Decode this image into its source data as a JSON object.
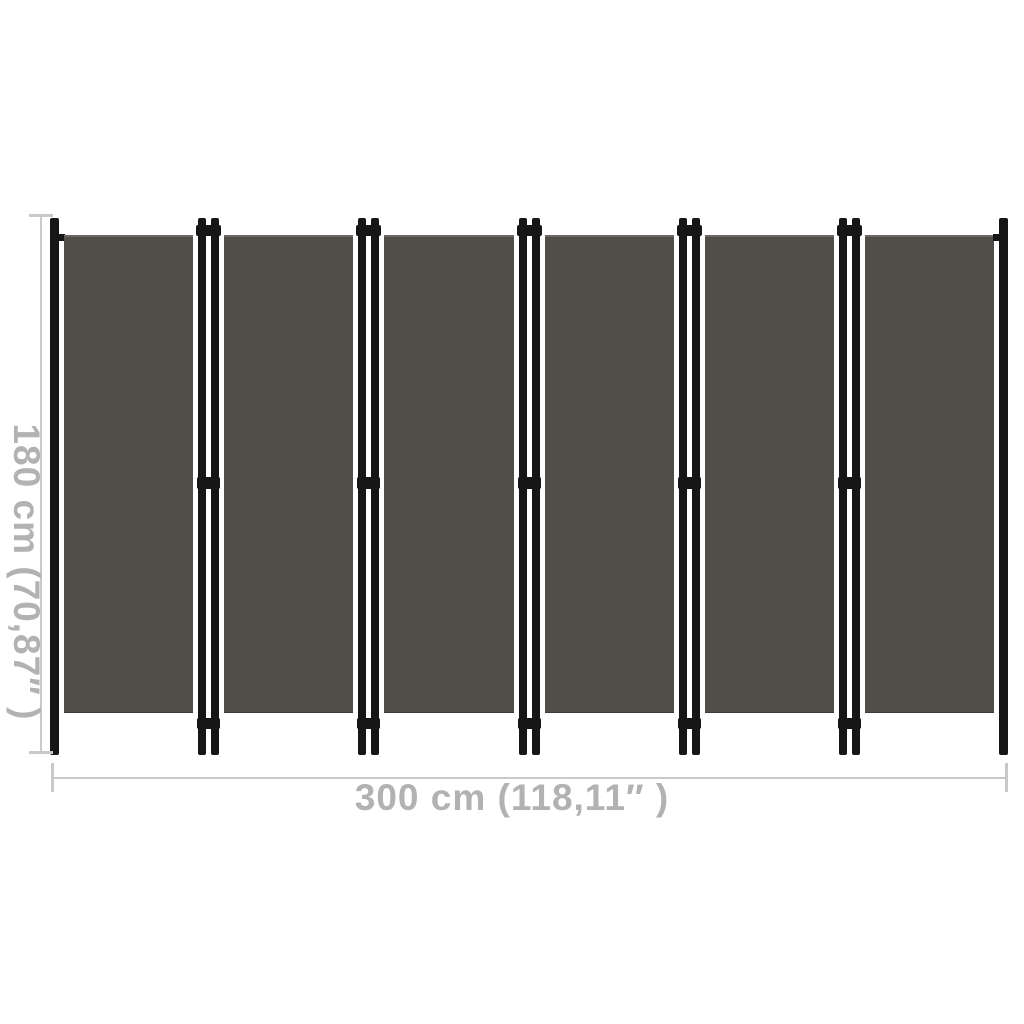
{
  "diagram": {
    "panel_count": 6
  },
  "dimensions": {
    "height_label": "180 cm (70,87″ )",
    "width_label": "300 cm (118,11″ )"
  },
  "colors": {
    "fabric": "#514D49",
    "fabric_top_edge": "#6B665E",
    "frame": "#161616",
    "dimension_line": "#C9C9C9",
    "dimension_text": "#B3B1B1",
    "background": "#FFFFFF"
  }
}
